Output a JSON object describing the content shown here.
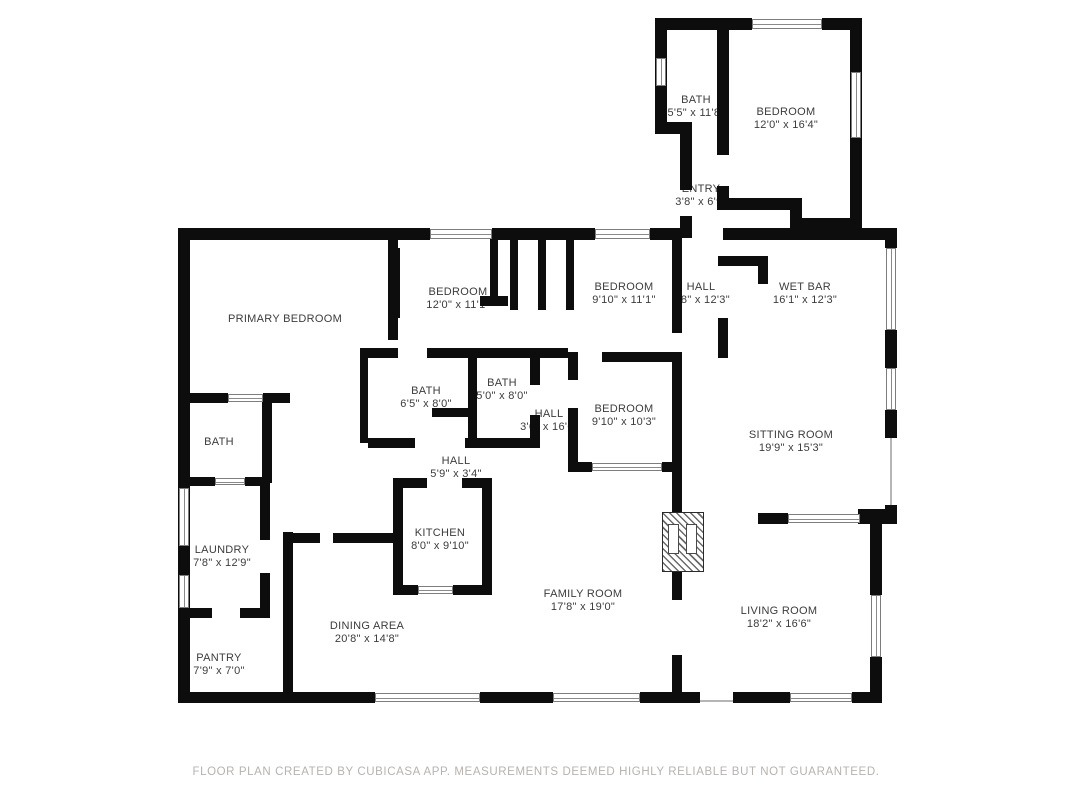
{
  "floor_plan": {
    "rooms": [
      {
        "name": "BATH",
        "dims": "5'5\" x 11'8\""
      },
      {
        "name": "BEDROOM",
        "dims": "12'0\" x 16'4\""
      },
      {
        "name": "ENTRY",
        "dims": "3'8\" x 6'9\""
      },
      {
        "name": "PRIMARY BEDROOM",
        "dims": ""
      },
      {
        "name": "BEDROOM",
        "dims": "12'0\" x 11'1\""
      },
      {
        "name": "BEDROOM",
        "dims": "9'10\" x 11'1\""
      },
      {
        "name": "HALL",
        "dims": "3'8\" x 12'3\""
      },
      {
        "name": "WET BAR",
        "dims": "16'1\" x 12'3\""
      },
      {
        "name": "BATH",
        "dims": "6'5\" x 8'0\""
      },
      {
        "name": "BATH",
        "dims": "5'0\" x 8'0\""
      },
      {
        "name": "HALL",
        "dims": "3'6\" x 16'6\""
      },
      {
        "name": "BEDROOM",
        "dims": "9'10\" x 10'3\""
      },
      {
        "name": "SITTING ROOM",
        "dims": "19'9\" x 15'3\""
      },
      {
        "name": "BATH",
        "dims": ""
      },
      {
        "name": "HALL",
        "dims": "5'9\" x 3'4\""
      },
      {
        "name": "KITCHEN",
        "dims": "8'0\" x 9'10\""
      },
      {
        "name": "LAUNDRY",
        "dims": "7'8\" x 12'9\""
      },
      {
        "name": "FAMILY ROOM",
        "dims": "17'8\" x 19'0\""
      },
      {
        "name": "LIVING ROOM",
        "dims": "18'2\" x 16'6\""
      },
      {
        "name": "PANTRY",
        "dims": "7'9\" x 7'0\""
      },
      {
        "name": "DINING AREA",
        "dims": "20'8\" x 14'8\""
      }
    ],
    "footer": "FLOOR PLAN CREATED BY CUBICASA APP. MEASUREMENTS DEEMED HIGHLY RELIABLE BUT NOT GUARANTEED.",
    "colors": {
      "wall": "#0d0d0d",
      "window_border": "#7d7d7d",
      "footer_text": "#b6b3b0"
    }
  }
}
